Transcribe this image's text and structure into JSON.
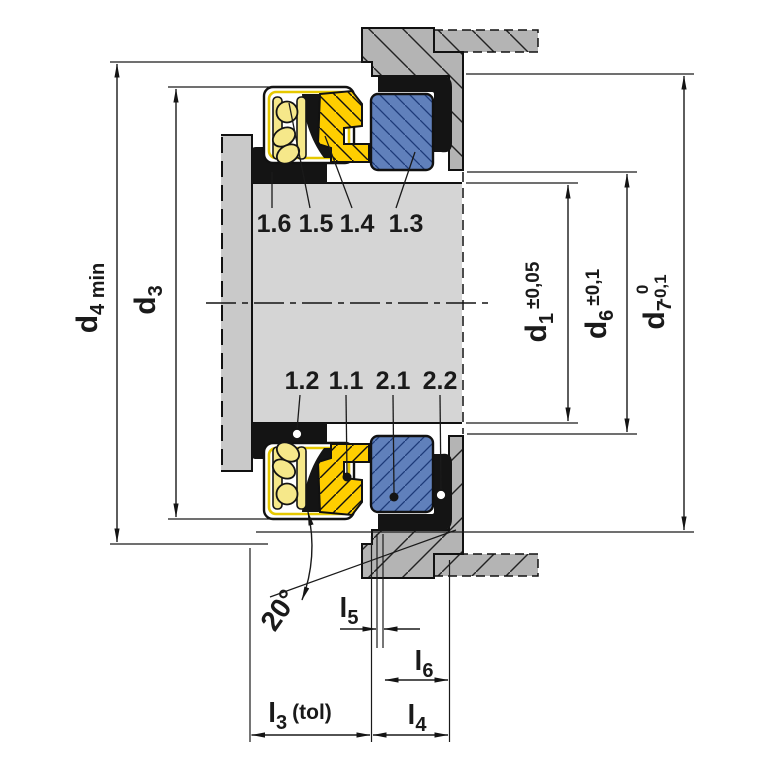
{
  "drawing_type": "mechanical-seal-cross-section",
  "part_labels": {
    "top": [
      "1.6",
      "1.5",
      "1.4",
      "1.3"
    ],
    "bottom": [
      "1.2",
      "1.1",
      "2.1",
      "2.2"
    ]
  },
  "dimensions": {
    "d4": {
      "base": "d",
      "sub": "4 min"
    },
    "d3": {
      "base": "d",
      "sub": "3"
    },
    "d1": {
      "base": "d",
      "sub": "1",
      "tol": "±0,05"
    },
    "d6": {
      "base": "d",
      "sub": "6",
      "tol": "±0,1"
    },
    "d7": {
      "base": "d",
      "sub": "7",
      "tol_upper": "0",
      "tol_lower": "-0,1"
    },
    "l3": {
      "base": "l",
      "sub": "3",
      "suffix": "(tol)"
    },
    "l4": {
      "base": "l",
      "sub": "4"
    },
    "l5": {
      "base": "l",
      "sub": "5"
    },
    "l6": {
      "base": "l",
      "sub": "6"
    },
    "angle": {
      "value": "20°"
    }
  },
  "colors": {
    "seal_face_yellow": "#ffce00",
    "spring_yellow": "#f6e88a",
    "seat_blue": "#6080bb",
    "elastomer_black": "#141414",
    "housing_gray": "#b4b4b4",
    "shaft_gray": "#d5d5d5",
    "flange_gray": "#c9c9c9"
  }
}
